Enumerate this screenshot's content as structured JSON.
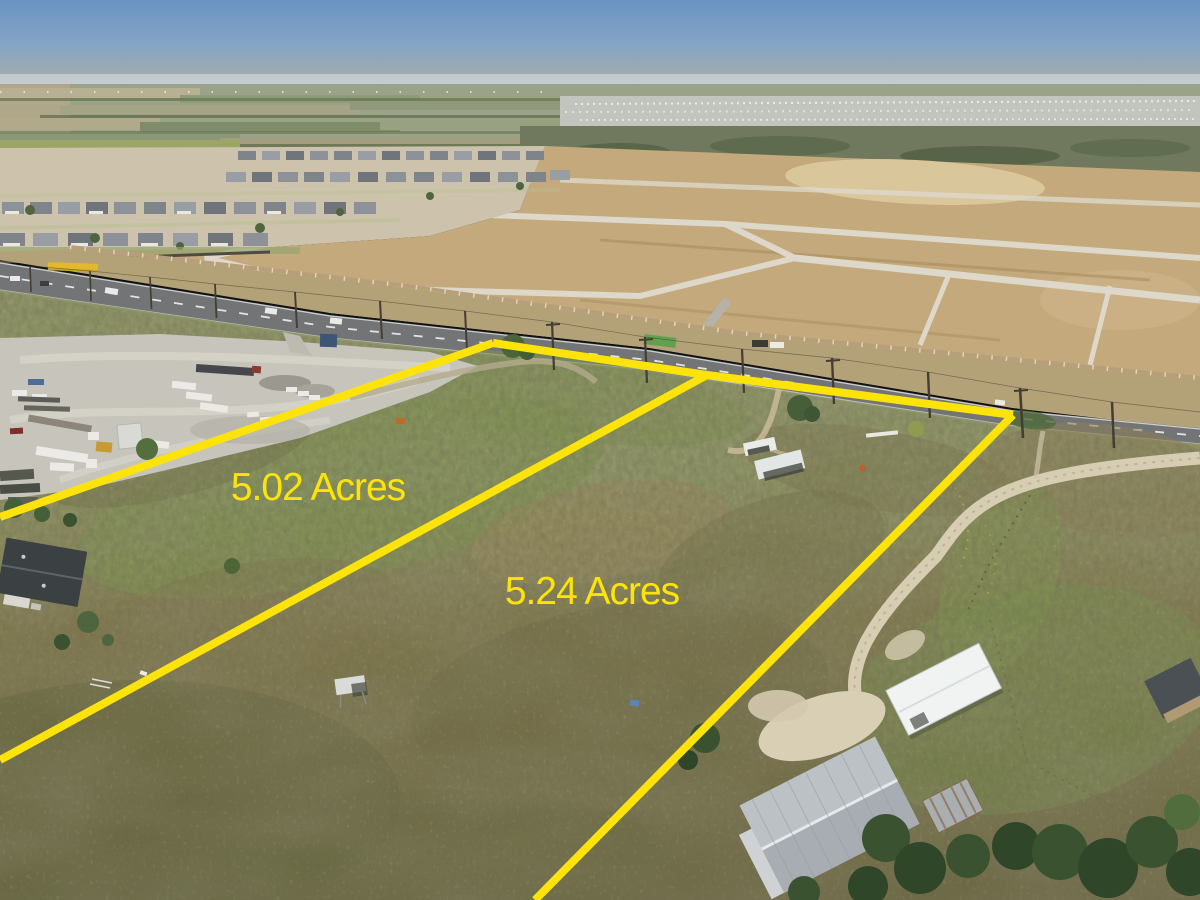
{
  "annotations": {
    "accent_color": "#FCE40A",
    "stroke_width": 8,
    "parcels": [
      {
        "label": "5.02 Acres",
        "label_x": 318,
        "label_y": 500
      },
      {
        "label": "5.24 Acres",
        "label_x": 592,
        "label_y": 604
      }
    ],
    "boundary_lines": {
      "parcel1_top": "0,517 493,343",
      "road_frontage": "493,343 707,375 1013,415",
      "parcel_divider": "707,375 0,760",
      "parcel2_right": "1013,415 535,900"
    }
  }
}
